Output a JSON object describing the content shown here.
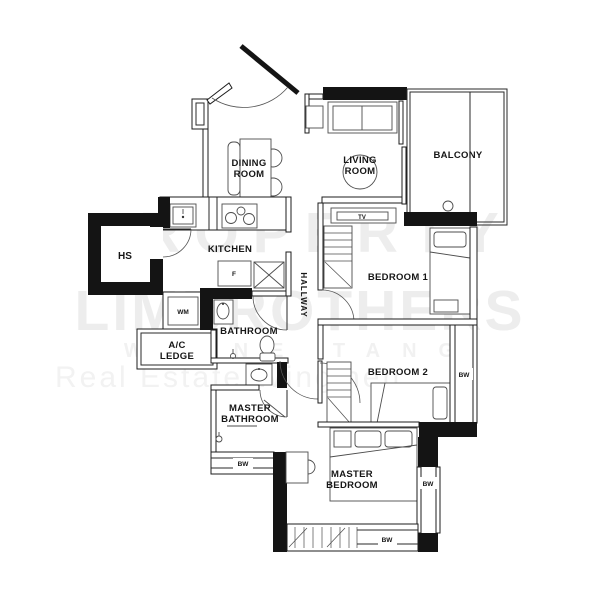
{
  "watermark": {
    "line1": "PROPERTY",
    "line2": "LIMBROTHERS",
    "line3": "WAYNE TANG",
    "line4": "Real Estate Wingmen"
  },
  "rooms": {
    "dining": {
      "line1": "DINING",
      "line2": "ROOM"
    },
    "living": {
      "line1": "LIVING",
      "line2": "ROOM"
    },
    "balcony": "BALCONY",
    "kitchen": "KITCHEN",
    "household_shelter": "HS",
    "hallway": "HALLWAY",
    "bedroom1": "BEDROOM 1",
    "bedroom2": "BEDROOM 2",
    "bathroom": "BATHROOM",
    "master_bathroom": {
      "line1": "MASTER",
      "line2": "BATHROOM"
    },
    "master_bedroom": {
      "line1": "MASTER",
      "line2": "BEDROOM"
    },
    "ac_ledge": {
      "line1": "A/C",
      "line2": "LEDGE"
    }
  },
  "fixtures": {
    "tv": "TV",
    "fridge": "F",
    "washing_machine": "WM"
  },
  "bay_windows": {
    "master_bathroom": "BW",
    "bedroom2": "BW",
    "master_bedroom_side": "BW",
    "master_bedroom_bottom": "BW"
  },
  "colors": {
    "wall": "#1c1c1c",
    "furniture_line": "#4c4c4c",
    "watermark": "#ededed",
    "background": "#ffffff"
  }
}
